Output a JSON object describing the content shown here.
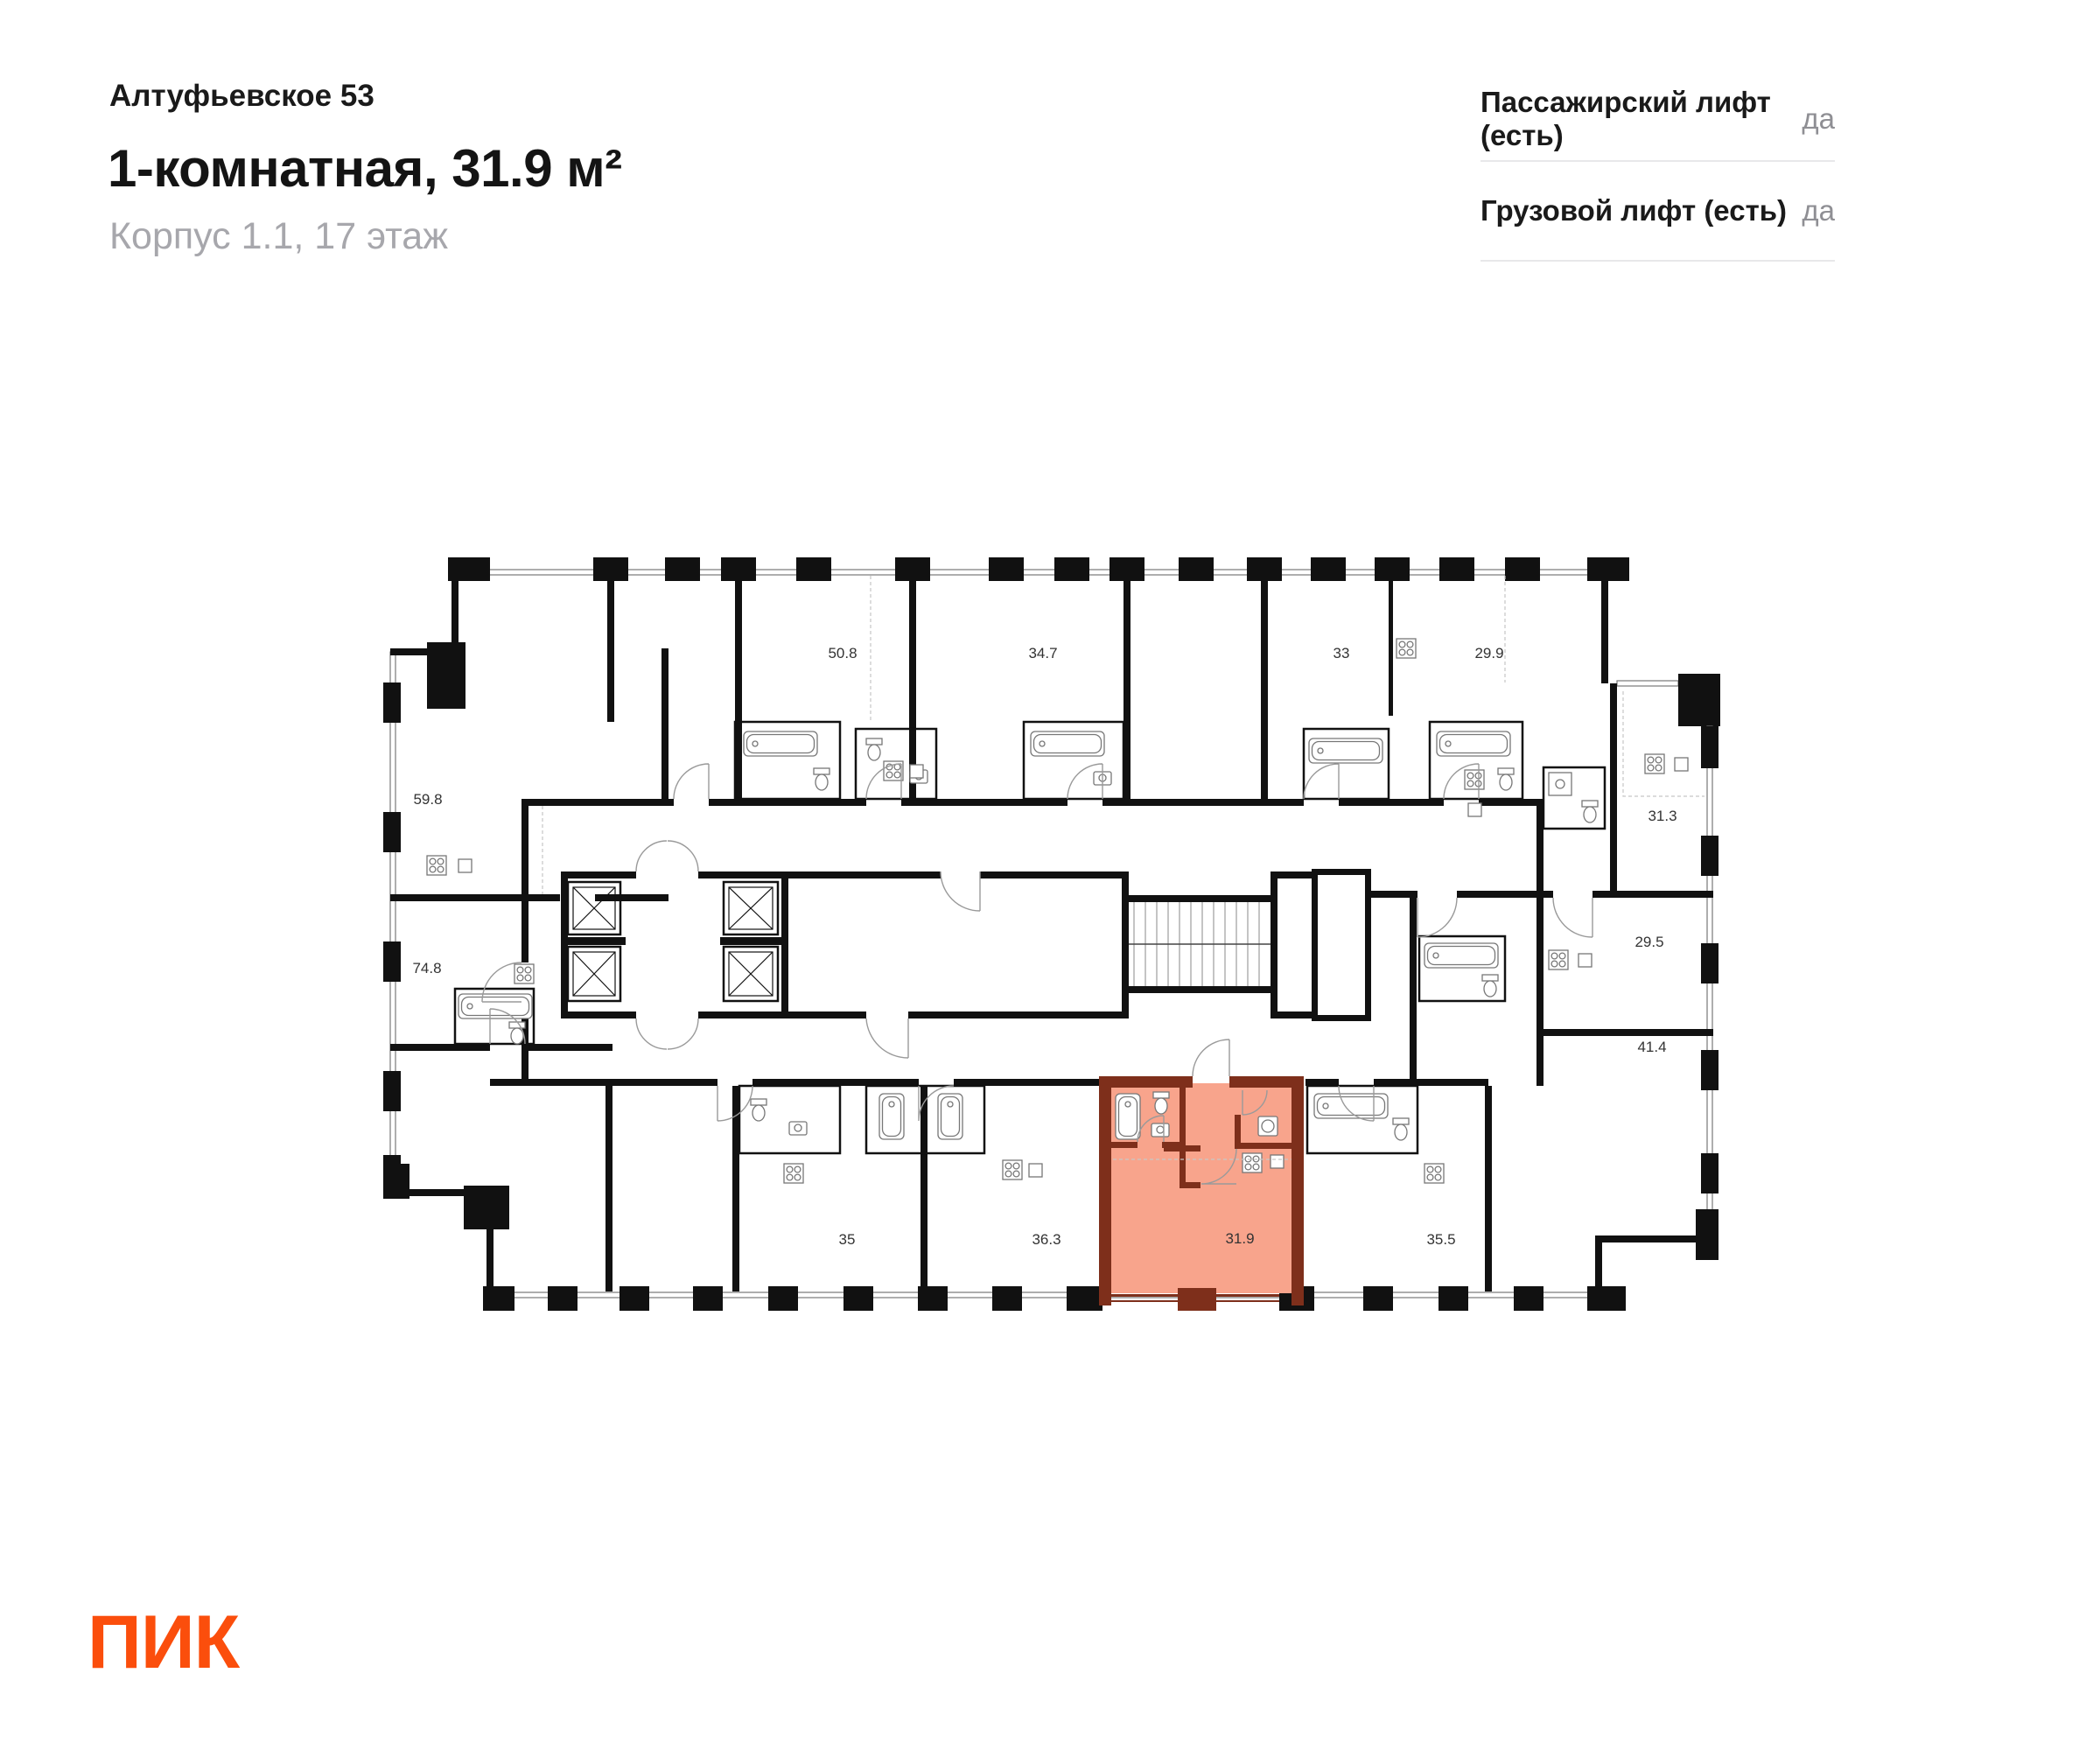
{
  "header": {
    "project": "Алтуфьевское 53",
    "title": "1-комнатная, 31.9 м²",
    "subtitle": "Корпус 1.1, 17 этаж"
  },
  "lifts": [
    {
      "label": "Пассажирский лифт (есть)",
      "value": "да"
    },
    {
      "label": "Грузовой лифт (есть)",
      "value": "да"
    }
  ],
  "plan": {
    "highlighted_area": "31.9",
    "labels": [
      {
        "text": "59.8"
      },
      {
        "text": "50.8"
      },
      {
        "text": "34.7"
      },
      {
        "text": "33"
      },
      {
        "text": "29.9"
      },
      {
        "text": "31.3"
      },
      {
        "text": "74.8"
      },
      {
        "text": "29.5"
      },
      {
        "text": "41.4"
      },
      {
        "text": "35"
      },
      {
        "text": "36.3"
      },
      {
        "text": "31.9"
      },
      {
        "text": "35.5"
      }
    ]
  },
  "footer": {
    "logo": "ПИК"
  },
  "colors": {
    "accent": "#FB4E0C",
    "highlight_fill": "#F8A48C",
    "highlight_wall": "#7E2F1B",
    "wall": "#111111",
    "subtitle_gray": "#A7A7AC",
    "value_gray": "#8F8F94",
    "divider": "#E8E8EA"
  }
}
